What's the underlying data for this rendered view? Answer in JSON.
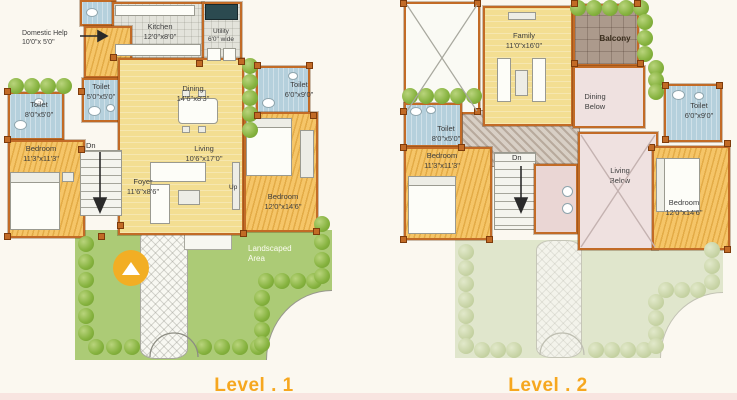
{
  "colors": {
    "accent": "#F6A71F",
    "wall": "#C26B26",
    "garden": "#ACCB76",
    "bed": "#F5C568",
    "yellow": "#F3DE92",
    "toilet": "#B5D0DC",
    "balcony": "#AC9A8C",
    "below": "#EFE1E0",
    "marker": "#F2AE24"
  },
  "level1": {
    "title": "Level . 1",
    "annotation": {
      "line1": "Domestic Help",
      "line2": "10'0\"x 5'0\""
    },
    "kitchen": {
      "label": "Kitchen",
      "dims": "12'0\"x8'0\""
    },
    "utility": {
      "line1": "Utility",
      "line2": "6'0\" wide"
    },
    "toilet_small": {
      "label": "Toilet",
      "dims": "5'0\"x5'0\""
    },
    "toilet_left": {
      "label": "Toilet",
      "dims": "8'0\"x5'0\""
    },
    "toilet_right": {
      "label": "Toilet",
      "dims": "6'0\"x9'0\""
    },
    "dining": {
      "label": "Dining",
      "dims": "14'6\"x8'3\""
    },
    "living": {
      "label": "Living",
      "dims": "10'6\"x17'0\""
    },
    "foyer": {
      "label": "Foyer",
      "dims": "11'6\"x8'6\""
    },
    "bedroom_left": {
      "label": "Bedroom",
      "dims": "11'3\"x11'3\""
    },
    "bedroom_right": {
      "label": "Bedroom",
      "dims": "12'0\"x14'6\""
    },
    "landscaped": {
      "line1": "Landscaped",
      "line2": "Area"
    },
    "stairs_down": "Dn",
    "stairs_up": "Up"
  },
  "level2": {
    "title": "Level . 2",
    "family": {
      "label": "Family",
      "dims": "11'0\"x16'0\""
    },
    "balcony": {
      "label": "Balcony"
    },
    "dining_below": {
      "line1": "Dining",
      "line2": "Below"
    },
    "living_below": {
      "line1": "Living",
      "line2": "Below"
    },
    "toilet_left": {
      "label": "Toilet",
      "dims": "8'0\"x5'0\""
    },
    "toilet_right": {
      "label": "Toilet",
      "dims": "6'0\"x9'0\""
    },
    "bedroom_left": {
      "label": "Bedroom",
      "dims": "11'3\"x11'3\""
    },
    "bedroom_right": {
      "label": "Bedroom",
      "dims": "12'0\"x14'6\""
    },
    "stairs_down": "Dn"
  }
}
